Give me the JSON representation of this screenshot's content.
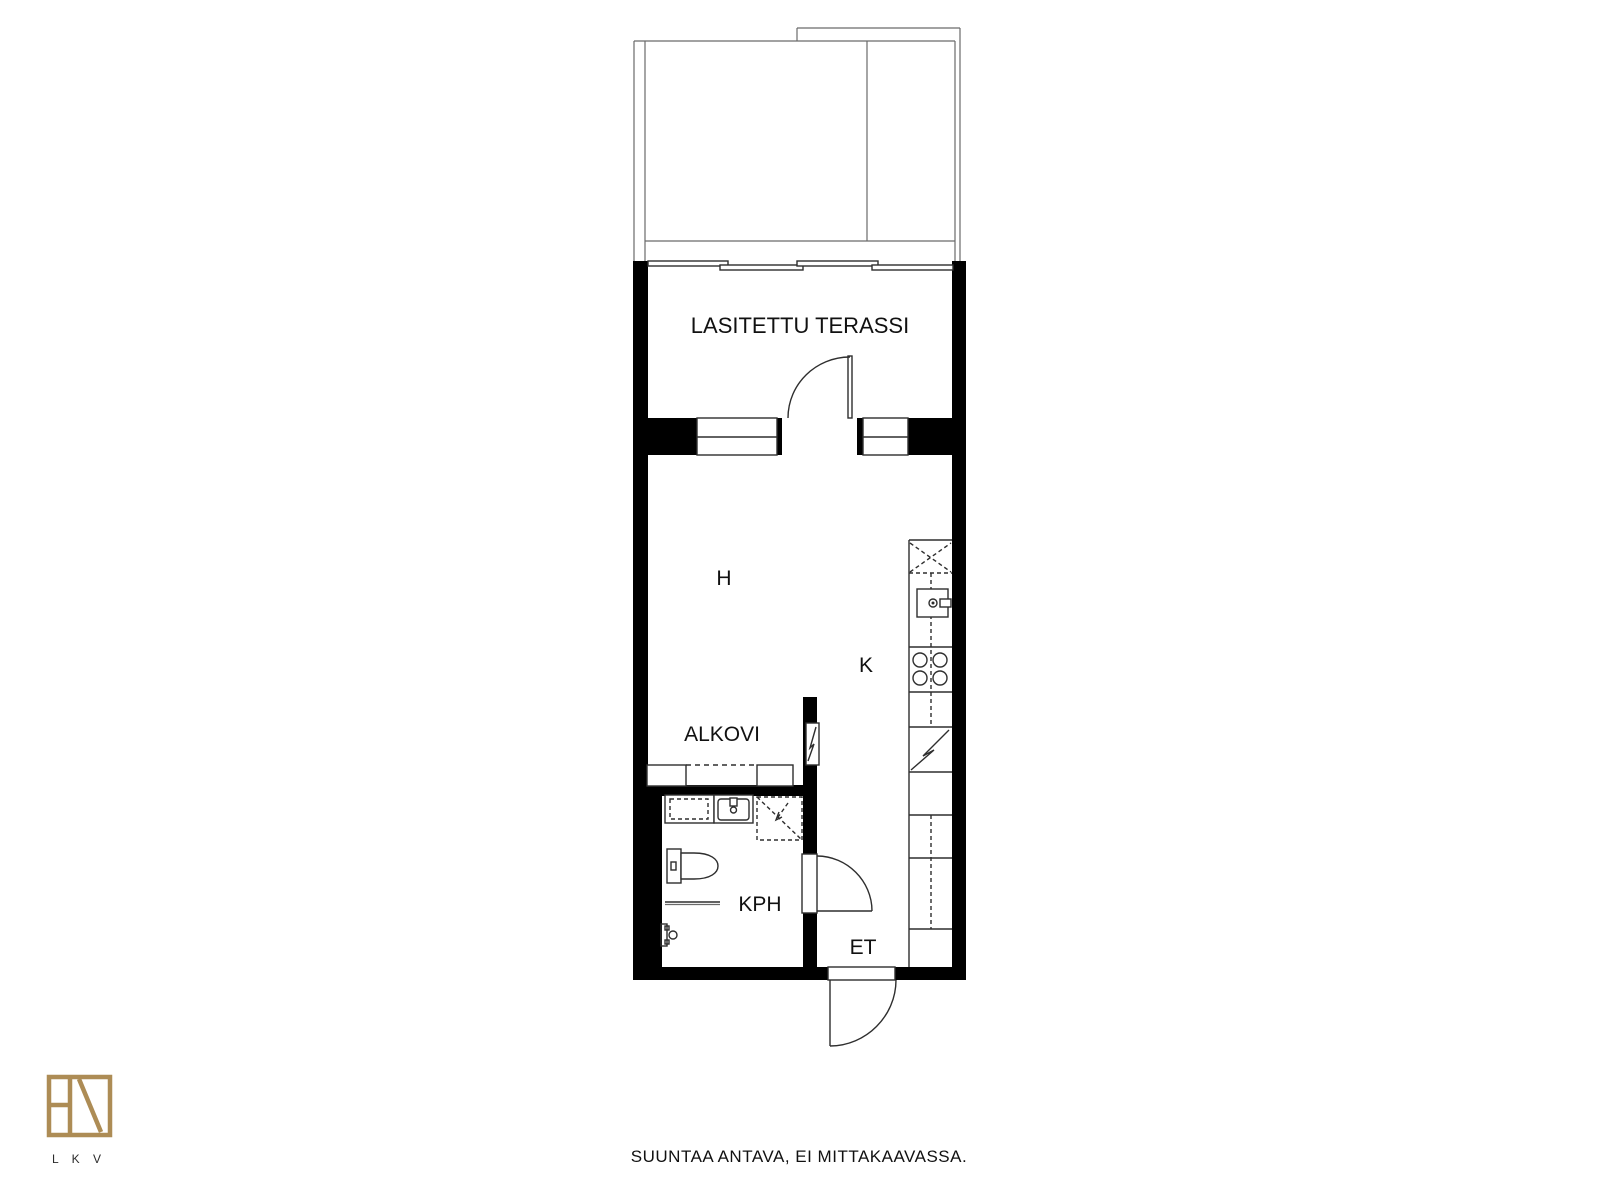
{
  "rooms": {
    "terrace": "LASITETTU TERASSI",
    "main": "H",
    "kitchen": "K",
    "alcove": "ALKOVI",
    "bathroom": "KPH",
    "entry": "ET"
  },
  "footer": {
    "note": "SUUNTAA ANTAVA, EI MITTAKAAVASSA."
  },
  "logo": {
    "text": "L K V"
  },
  "colors": {
    "wall": "#000000",
    "line": "#2e2e2e",
    "logo_gold": "#ad8c55",
    "background": "#ffffff",
    "label_text": "#111111"
  },
  "fixtures": [
    "sliding-glass-wall",
    "terrace-door",
    "window",
    "stove",
    "kitchen-sink",
    "dishwasher",
    "fridge-reservation",
    "folding-door",
    "wardrobe",
    "bathroom-sink",
    "washer-reservation",
    "toilet",
    "shower-rail",
    "shower-faucet",
    "bathroom-door",
    "entry-door"
  ]
}
